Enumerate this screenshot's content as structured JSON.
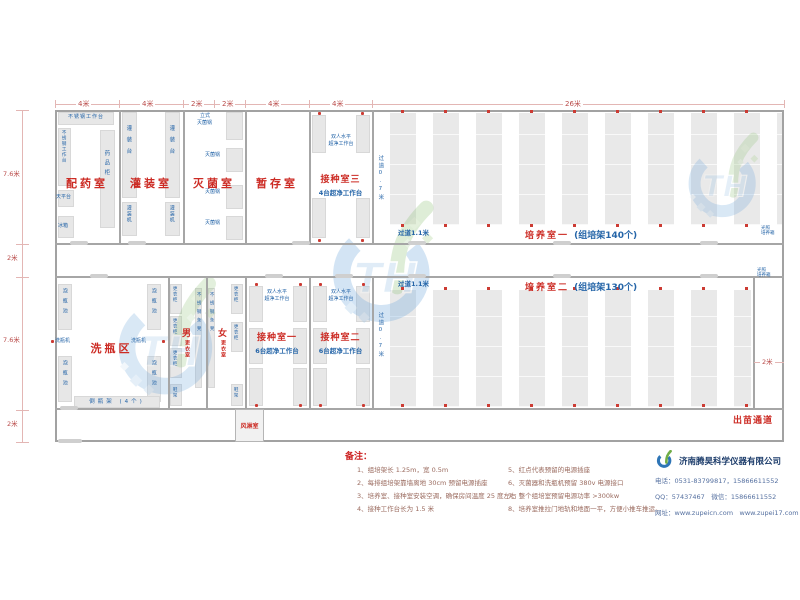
{
  "dims": {
    "top": [
      "4米",
      "4米",
      "2米",
      "2米",
      "4米",
      "4米",
      "26米"
    ],
    "left": [
      "7.6米",
      "2米",
      "7.6米",
      "2米"
    ],
    "right": "2米"
  },
  "rooms": {
    "peiyao": "配药室",
    "guanzhuang": "灌装室",
    "miejun": "灭菌室",
    "zancun": "暂存室",
    "jiezhong3": "接种室三",
    "jiezhong3_sub": "4台超净工作台",
    "peiyang1": "培养室一",
    "peiyang1_sub": "(组培架140个)",
    "xipingqu": "洗瓶区",
    "nan": "男",
    "nv": "女",
    "gengyishi": "更衣室",
    "jiezhong1": "接种室一",
    "jiezhong2": "接种室二",
    "jiezhong12_sub": "6台超净工作台",
    "peiyang2": "培养室二",
    "peiyang2_sub": "(组培架130个)",
    "fenglinshi": "风淋室",
    "chumiao": "出苗通道"
  },
  "eq": {
    "worktop": "不锈钢工作台",
    "tianpingtai": "天平台",
    "bingxiang": "冰箱",
    "yaopingui": "药品柜",
    "guanzhuangtai": "灌装台",
    "guanzhuangji": "灌装机",
    "lishi_l1": "立式",
    "lishi_l2": "灭菌锅",
    "miejunguo": "灭菌锅",
    "shuangren_l1": "双人水平",
    "shuangren_l2": "超净工作台",
    "guodao07": "过道0.7米",
    "guodao11": "过道1.1米",
    "guangzhao_l1": "光照",
    "guangzhao_l2": "培养箱",
    "paopingchi": "泡瓶池",
    "xipingji": "洗瓶机",
    "daopingjia": "倒瓶架 (4个)",
    "gengyigui": "更衣柜",
    "xiejia": "鞋架",
    "tiaodeng": "不锈钢条凳"
  },
  "notes": {
    "title": "备注：",
    "items": [
      "1、组培架长 1.25m，宽 0.5m",
      "2、每排组培架靠墙离地 30cm 预留电源插座",
      "3、培养室、接种室安装空调，确保房间温度 25 度左右",
      "4、接种工作台长为 1.5 米",
      "5、红点代表预留的电源插座",
      "6、灭菌器和洗瓶机预留 380v 电源接口",
      "7、整个组培室预留电源功率 >300kw",
      "8、培养室推拉门地轨和地面一平，方便小推车推运。"
    ]
  },
  "company": {
    "name": "济南腾昊科学仪器有限公司",
    "phone": "电话：0531-83799817，15866611552",
    "qq": "QQ：57437467　微信：15866611552",
    "web": "网址：www.zupeicn.com　www.zupei17.com"
  },
  "watermark": "TH",
  "colors": {
    "room_label": "#cc2b24",
    "equip_label": "#2565a8",
    "dimension": "#b94a48",
    "note_text": "#9a6a5e",
    "company_text": "#5570a0",
    "wall": "#a6a6a6"
  }
}
